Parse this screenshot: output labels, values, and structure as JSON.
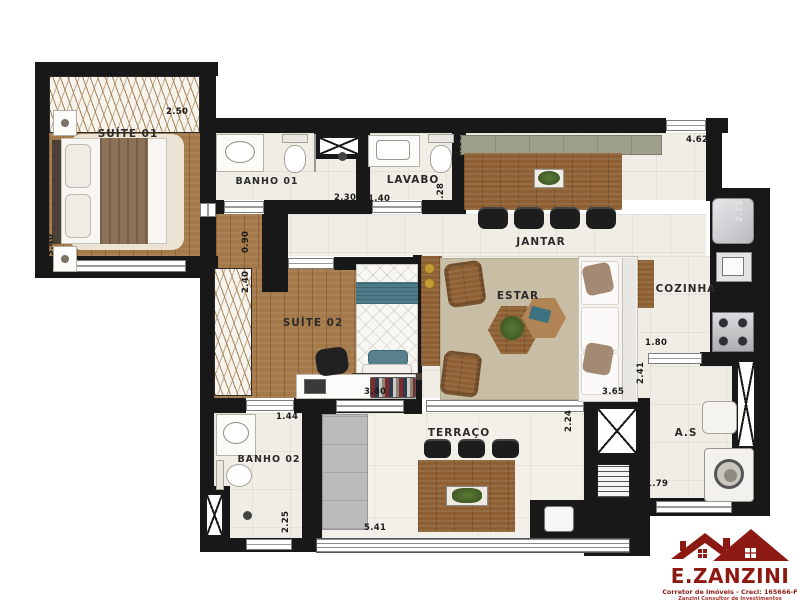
{
  "labels": {
    "suite01": "SUÍTE 01",
    "banho01": "BANHO 01",
    "lavabo": "LAVABO",
    "jantar": "JANTAR",
    "cozinha": "COZINHA",
    "suite02": "SUÍTE 02",
    "estar": "ESTAR",
    "banho02": "BANHO 02",
    "terraco": "TERRAÇO",
    "servico": "A.S"
  },
  "dims": {
    "suite01_width": "2.50",
    "suite01_depth": "3.40",
    "banho01_depth": "1.25",
    "banho01_width": "2.30",
    "lavabo_width": "1.40",
    "lavabo_depth": "1.28",
    "jantar_depth": "4.80",
    "jantar_width": "4.62",
    "cozinha_depth": "2.75",
    "hall_width": "0.90",
    "suite02_depth": "2.40",
    "suite02_width": "3.40",
    "suite02_hall": "1.44",
    "kitchen_pass": "1.80",
    "servico_depth": "2.41",
    "servico_width": "1.79",
    "estar_depth": "3.65",
    "banho02_depth": "2.25",
    "terraco_width": "5.41",
    "terraco_depth": "2.24"
  },
  "logo": {
    "brand": "E.ZANZINI",
    "tagline": "Corretor de Imóveis - Creci: 165666-F",
    "subtagline": "Zanzini Consultor de Investimentos Imobiliários"
  },
  "colors": {
    "wall": "#181818",
    "wood_floor": "#a57a4b",
    "wood_furniture": "#8d5f33",
    "tile": "#f0ede6",
    "teal_accent": "#4d7b87",
    "logo_red": "#8c1a13"
  }
}
